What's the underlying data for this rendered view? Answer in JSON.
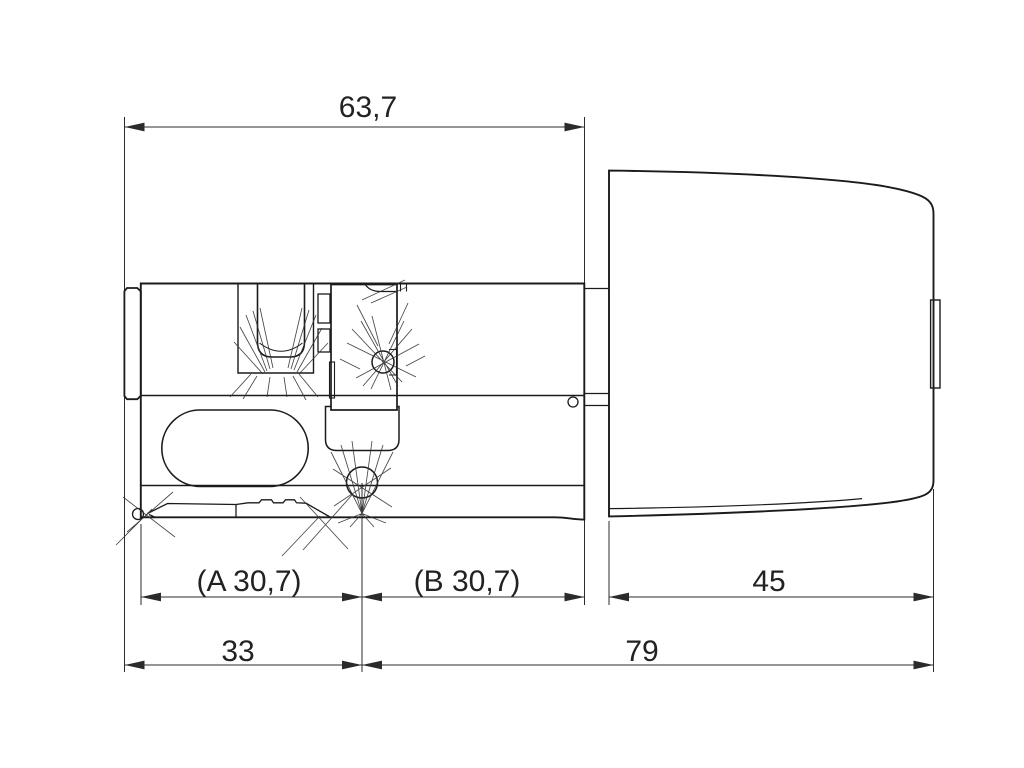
{
  "dimensions": {
    "overall": "63,7",
    "module_a": "(A 30,7)",
    "module_b": "(B 30,7)",
    "knob": "45",
    "front": "33",
    "rear": "79"
  },
  "colors": {
    "background": "#ffffff",
    "part_line": "#1b1b1b",
    "dimension_line": "#2b2b2b",
    "text": "#222222"
  }
}
